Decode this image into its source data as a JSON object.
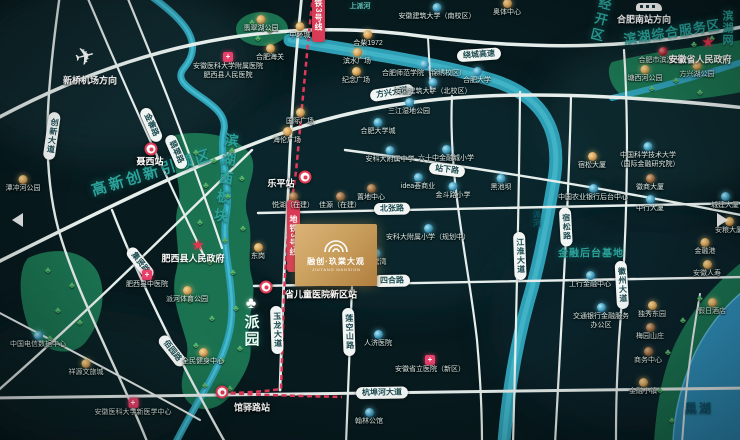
{
  "tree_glyph": "♣",
  "colors": {
    "bg": "#071a1e",
    "zone_teal": "#2aa39b",
    "metro_red": "#d93a55",
    "road_white": "#e6eeec",
    "river_blue": "#2f9fb5",
    "park_green": "#1c7a55",
    "lake_blue": "#2f8fba",
    "logo_gold": "#caa05e"
  },
  "logo": {
    "x": 295,
    "y": 224,
    "w": 82,
    "h": 62,
    "title": "融创·玖棠大观",
    "sub": "JIUTANG MANSION"
  },
  "zones": [
    {
      "label": "高新创新引领区",
      "x": 152,
      "y": 172,
      "rot": -17,
      "size": 15,
      "ls": 3,
      "mode": "h"
    },
    {
      "label": "滨湖西板块",
      "x": 226,
      "y": 180,
      "rot": 8,
      "size": 14,
      "ls": 5,
      "mode": "v"
    },
    {
      "label": "经开区",
      "x": 600,
      "y": 20,
      "rot": 14,
      "size": 13,
      "ls": 3,
      "mode": "v"
    },
    {
      "label": "滨湖综合服务区",
      "x": 672,
      "y": 31,
      "rot": -9,
      "size": 13,
      "ls": 1,
      "mode": "h"
    },
    {
      "label": "金融后台基地",
      "x": 591,
      "y": 252,
      "rot": 0,
      "size": 10,
      "ls": 1,
      "mode": "h"
    },
    {
      "label": "滨湖网",
      "x": 727,
      "y": 28,
      "rot": 0,
      "size": 11,
      "ls": 1,
      "mode": "v"
    },
    {
      "label": "派园",
      "x": 251,
      "y": 331,
      "rot": 0,
      "size": 15,
      "ls": 2,
      "mode": "v",
      "color": "#eafff2"
    },
    {
      "label": "巢湖",
      "x": 699,
      "y": 408,
      "rot": 0,
      "size": 12,
      "ls": 2,
      "mode": "h",
      "color": "#10506e"
    },
    {
      "label": "派河",
      "x": 537,
      "y": 219,
      "rot": 0,
      "size": 8,
      "ls": 1,
      "mode": "v",
      "color": "#0c5568"
    },
    {
      "label": "上派河",
      "x": 360,
      "y": 6,
      "rot": 0,
      "size": 7,
      "ls": 0,
      "mode": "h",
      "color": "#63c0b6"
    }
  ],
  "road_pills": [
    {
      "label": "绕城高速",
      "x": 479,
      "y": 55,
      "rot": -4,
      "mode": "h"
    },
    {
      "label": "方兴大道",
      "x": 392,
      "y": 93,
      "rot": -9,
      "mode": "h"
    },
    {
      "label": "北张路",
      "x": 392,
      "y": 209,
      "rot": -1,
      "mode": "h"
    },
    {
      "label": "四合路",
      "x": 392,
      "y": 281,
      "rot": -1,
      "mode": "h"
    },
    {
      "label": "站下路",
      "x": 447,
      "y": 170,
      "rot": 7,
      "mode": "h"
    },
    {
      "label": "杭埠河大道",
      "x": 382,
      "y": 393,
      "rot": -1,
      "mode": "h"
    },
    {
      "label": "创新大道",
      "x": 52,
      "y": 136,
      "rot": 8,
      "mode": "v"
    },
    {
      "label": "金寨路",
      "x": 151,
      "y": 125,
      "rot": 66,
      "mode": "h"
    },
    {
      "label": "翡翠路",
      "x": 176,
      "y": 152,
      "rot": 66,
      "mode": "h"
    },
    {
      "label": "集贤路",
      "x": 140,
      "y": 263,
      "rot": 52,
      "mode": "h"
    },
    {
      "label": "佰园路",
      "x": 172,
      "y": 351,
      "rot": 52,
      "mode": "h"
    },
    {
      "label": "玉龙大道",
      "x": 277,
      "y": 330,
      "rot": -2,
      "mode": "v"
    },
    {
      "label": "莲空山路",
      "x": 349,
      "y": 332,
      "rot": -2,
      "mode": "v"
    },
    {
      "label": "江淮大道",
      "x": 520,
      "y": 256,
      "rot": -2,
      "mode": "v"
    },
    {
      "label": "宿松路",
      "x": 566,
      "y": 227,
      "rot": -3,
      "mode": "v"
    },
    {
      "label": "徽州大道",
      "x": 622,
      "y": 285,
      "rot": -3,
      "mode": "v"
    }
  ],
  "metro_ribbons": [
    {
      "label": "地铁3号线",
      "x": 287,
      "y": 200,
      "h": 72
    },
    {
      "label": "地铁3号线",
      "x": 312,
      "y": -20,
      "h": 62
    }
  ],
  "stations": [
    {
      "label": "乐平站",
      "ix": 305,
      "iy": 177,
      "lx": 281,
      "ly": 183
    },
    {
      "label": "省儿童医院新区站",
      "ix": 266,
      "iy": 287,
      "lx": 321,
      "ly": 294
    },
    {
      "label": "馆驿路站",
      "ix": 222,
      "iy": 392,
      "lx": 252,
      "ly": 407
    },
    {
      "label": "聂西站",
      "ix": 151,
      "iy": 149,
      "lx": 150,
      "ly": 161
    }
  ],
  "landmarks": {
    "airport": {
      "icon": "✈",
      "label": "新桥机场方向",
      "ix": 85,
      "iy": 57,
      "lx": 90,
      "ly": 80
    },
    "train": {
      "label": "合肥南站方向",
      "ix": 649,
      "iy": 7,
      "lx": 644,
      "ly": 19
    },
    "stars": [
      {
        "label": "安徽省人民政府",
        "sx": 708,
        "sy": 42,
        "lx": 700,
        "ly": 59
      },
      {
        "label": "肥西县人民政府",
        "sx": 198,
        "sy": 245,
        "lx": 193,
        "ly": 258
      }
    ],
    "big_tree": {
      "x": 251,
      "y": 304
    },
    "nav_left": {
      "x": 12,
      "y": 213
    },
    "nav_right": {
      "x": 717,
      "y": 213
    }
  },
  "pois": [
    {
      "x": 300,
      "y": 26,
      "t": "gold",
      "l": "中环城"
    },
    {
      "x": 368,
      "y": 34,
      "t": "gold",
      "l": "合柴1972"
    },
    {
      "x": 357,
      "y": 52,
      "t": "gold",
      "l": "滨水广场"
    },
    {
      "x": 356,
      "y": 71,
      "t": "gold",
      "l": "纪念广场"
    },
    {
      "x": 300,
      "y": 112,
      "t": "gold",
      "l": "国际广场"
    },
    {
      "x": 287,
      "y": 131,
      "t": "gold",
      "l": "海伦广场"
    },
    {
      "x": 270,
      "y": 48,
      "t": "gold",
      "l": "合肥海关"
    },
    {
      "x": 507,
      "y": 3,
      "t": "gold",
      "l": "奥体中心"
    },
    {
      "x": 437,
      "y": 7,
      "t": "blue",
      "l": "安徽建筑大学（南校区）"
    },
    {
      "x": 424,
      "y": 64,
      "t": "blue",
      "l": "合肥师范学院（锦绣校区）"
    },
    {
      "x": 433,
      "y": 82,
      "t": "blue",
      "l": "安徽建筑大学（北校区）"
    },
    {
      "x": 477,
      "y": 71,
      "t": "blue",
      "l": "合肥大学"
    },
    {
      "x": 409,
      "y": 102,
      "t": "blue",
      "l": "三江湿地公园"
    },
    {
      "x": 378,
      "y": 122,
      "t": "blue",
      "l": "合肥大学城"
    },
    {
      "x": 446,
      "y": 149,
      "t": "blue",
      "l": "六十中金融城小学"
    },
    {
      "x": 390,
      "y": 150,
      "t": "blue",
      "l": "安科大附属中学"
    },
    {
      "x": 418,
      "y": 177,
      "t": "blue",
      "l": "idea荟商业"
    },
    {
      "x": 453,
      "y": 186,
      "t": "blue",
      "l": "金斗路小学"
    },
    {
      "x": 501,
      "y": 178,
      "t": "blue",
      "l": "黑池坝"
    },
    {
      "x": 428,
      "y": 228,
      "t": "blue",
      "l": "安科大附属小学（规划中）"
    },
    {
      "x": 376,
      "y": 253,
      "t": "blue",
      "l": "白鹭湾"
    },
    {
      "x": 293,
      "y": 196,
      "t": "brown",
      "l": "悦湖（在建）"
    },
    {
      "x": 340,
      "y": 196,
      "t": "brown",
      "l": "佳源（在建）"
    },
    {
      "x": 371,
      "y": 188,
      "t": "brown",
      "l": "置地中心"
    },
    {
      "x": 378,
      "y": 334,
      "t": "blue",
      "l": "人济医院"
    },
    {
      "x": 369,
      "y": 412,
      "t": "blue",
      "l": "翰林公馆"
    },
    {
      "x": 203,
      "y": 352,
      "t": "gold",
      "l": "全民健身中心"
    },
    {
      "x": 187,
      "y": 290,
      "t": "gold",
      "l": "派河体育公园"
    },
    {
      "x": 147,
      "y": 274,
      "t": "pink",
      "l": "肥西县中医院"
    },
    {
      "x": 258,
      "y": 247,
      "t": "gold",
      "l": "东岗"
    },
    {
      "x": 38,
      "y": 335,
      "t": "blue",
      "l": "中国电信数据中心"
    },
    {
      "x": 86,
      "y": 363,
      "t": "gold",
      "l": "祥源文旅城"
    },
    {
      "x": 133,
      "y": 402,
      "t": "pink",
      "l": "安徽医科大学新医学中心"
    },
    {
      "x": 430,
      "y": 359,
      "t": "pink",
      "l": "安徽省立医院（新区）"
    },
    {
      "x": 228,
      "y": 56,
      "t": "cross",
      "l": "安徽医科大学附属医院",
      "l2": "肥西县人民医院"
    },
    {
      "x": 663,
      "y": 51,
      "t": "darkred",
      "l": "合肥市滨湖医院"
    },
    {
      "x": 645,
      "y": 69,
      "t": "gold",
      "l": "塘西河公园"
    },
    {
      "x": 697,
      "y": 65,
      "t": "gold",
      "l": "方兴湖公园"
    },
    {
      "x": 261,
      "y": 19,
      "t": "gold",
      "l": "翡翠湖公园"
    },
    {
      "x": 23,
      "y": 179,
      "t": "gold",
      "l": "潭冲河公园"
    },
    {
      "x": 592,
      "y": 156,
      "t": "gold",
      "l": "宿松大厦"
    },
    {
      "x": 650,
      "y": 178,
      "t": "brown",
      "l": "徽商大厦"
    },
    {
      "x": 650,
      "y": 199,
      "t": "blue",
      "l": "中行大厦"
    },
    {
      "x": 593,
      "y": 188,
      "t": "blue",
      "l": "中国农业银行后台中心"
    },
    {
      "x": 590,
      "y": 275,
      "t": "blue",
      "l": "工行金融中心"
    },
    {
      "x": 705,
      "y": 242,
      "t": "gold",
      "l": "金融港"
    },
    {
      "x": 707,
      "y": 264,
      "t": "gold",
      "l": "安徽人寿"
    },
    {
      "x": 712,
      "y": 302,
      "t": "gold",
      "l": "假日酒店"
    },
    {
      "x": 601,
      "y": 307,
      "t": "blue",
      "l": "交通银行金融服务",
      "l2": "办公区"
    },
    {
      "x": 652,
      "y": 305,
      "t": "gold",
      "l": "独秀东园"
    },
    {
      "x": 650,
      "y": 327,
      "t": "brown",
      "l": "梅园山庄"
    },
    {
      "x": 648,
      "y": 351,
      "t": "brown",
      "l": "商务中心"
    },
    {
      "x": 648,
      "y": 146,
      "t": "blue",
      "l": "中国科学技术大学",
      "l2": "（国际金融研究院）"
    },
    {
      "x": 725,
      "y": 196,
      "t": "blue",
      "l": "城建大厦"
    },
    {
      "x": 729,
      "y": 221,
      "t": "gold",
      "l": "安粮大厦"
    },
    {
      "x": 643,
      "y": 382,
      "t": "gold",
      "l": "金融小镇"
    }
  ],
  "trees": [
    [
      196,
      152
    ],
    [
      214,
      160
    ],
    [
      232,
      150
    ],
    [
      206,
      185
    ],
    [
      228,
      196
    ],
    [
      242,
      178
    ],
    [
      200,
      222
    ],
    [
      225,
      240
    ],
    [
      243,
      228
    ],
    [
      210,
      262
    ],
    [
      233,
      272
    ],
    [
      190,
      300
    ],
    [
      212,
      318
    ],
    [
      236,
      308
    ],
    [
      196,
      345
    ],
    [
      222,
      360
    ],
    [
      240,
      348
    ],
    [
      205,
      385
    ],
    [
      230,
      388
    ],
    [
      252,
      22
    ],
    [
      270,
      30
    ],
    [
      258,
      38
    ],
    [
      652,
      88
    ],
    [
      676,
      80
    ],
    [
      700,
      92
    ],
    [
      722,
      58
    ],
    [
      694,
      44
    ],
    [
      712,
      38
    ],
    [
      668,
      352
    ],
    [
      683,
      320
    ],
    [
      700,
      298
    ],
    [
      660,
      390
    ],
    [
      672,
      420
    ],
    [
      48,
      270
    ],
    [
      72,
      285
    ],
    [
      58,
      310
    ],
    [
      80,
      322
    ],
    [
      50,
      338
    ]
  ]
}
